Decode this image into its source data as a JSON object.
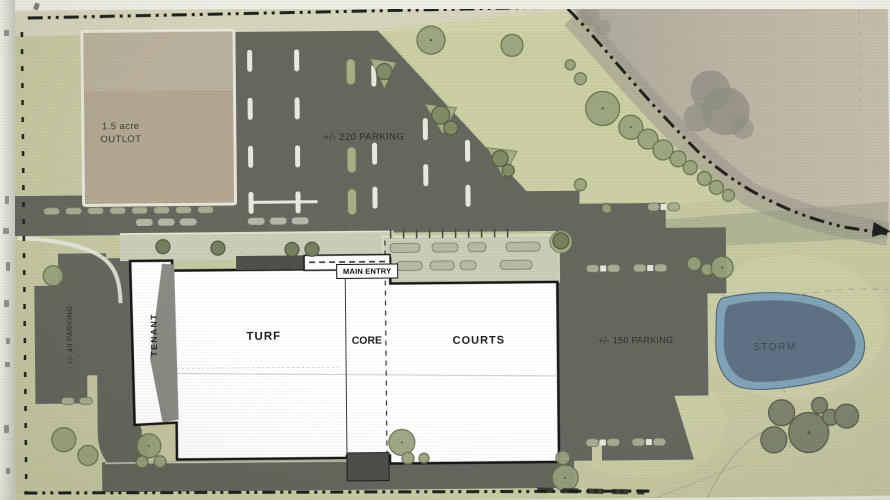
{
  "labels": {
    "outlot_area": "1.5 acre",
    "outlot_name": "OUTLOT",
    "north_parking": "+/- 220 PARKING",
    "west_parking": "+/- 40 PARKING",
    "east_parking": "+/- 150 PARKING",
    "main_entry": "MAIN ENTRY",
    "tenant": "TENANT",
    "turf": "TURF",
    "core": "CORE",
    "courts": "COURTS",
    "storm": "STORM"
  },
  "colors": {
    "grass": "#c6c8a2",
    "grass_light": "#d5d4bd",
    "asphalt": "#66675f",
    "asphalt_dark": "#4f504a",
    "outlot_pad": "#b1a793",
    "plaza": "#cbcdb8",
    "curb_white": "#e7e8da",
    "island_green": "#a6af88",
    "tree_fill": "#98a37c",
    "tree_stroke": "#5f6b4c",
    "aerial_tan": "#b7b0a2",
    "pond_outer": "#7ba1b9",
    "pond_inner": "#5e7183",
    "building": "#ffffff",
    "line_black": "#1e1e1c"
  }
}
